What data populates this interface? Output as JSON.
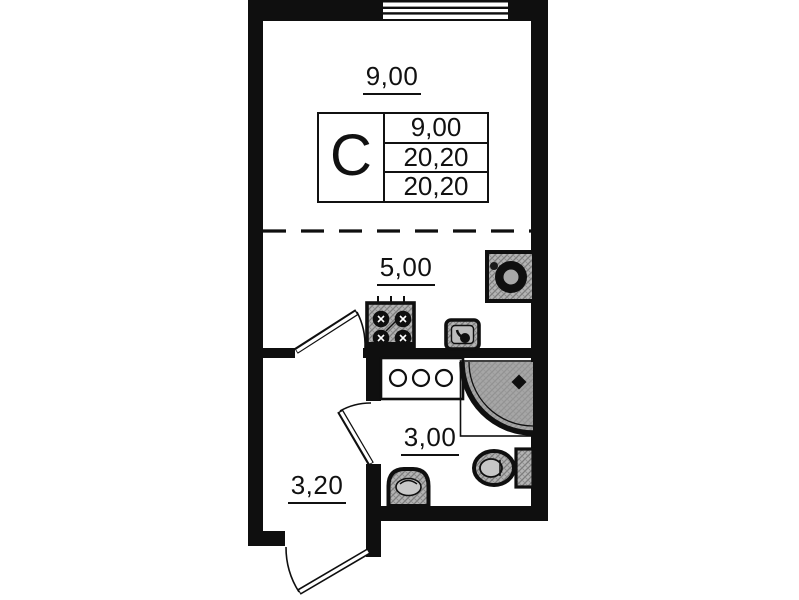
{
  "meta": {
    "description": "Studio apartment floor plan",
    "plan_type": "floor-plan"
  },
  "colors": {
    "wall": "#0f0f0f",
    "paper": "#ffffff",
    "fixture": "#b4b4b4",
    "hatch": "#7c7c7c",
    "tray": "#9e9e9e"
  },
  "unit": {
    "type_label": "С",
    "stats": [
      "9,00",
      "20,20",
      "20,20"
    ]
  },
  "rooms": {
    "living": {
      "label": "9,00"
    },
    "kitchen": {
      "label": "5,00"
    },
    "bathroom": {
      "label": "3,00"
    },
    "hallway": {
      "label": "3,20"
    }
  },
  "fixtures": [
    "window",
    "washing-machine",
    "stove",
    "kitchen-sink",
    "counter",
    "shower",
    "toilet",
    "wash-basin",
    "interior-door",
    "bathroom-door",
    "entry-door"
  ]
}
